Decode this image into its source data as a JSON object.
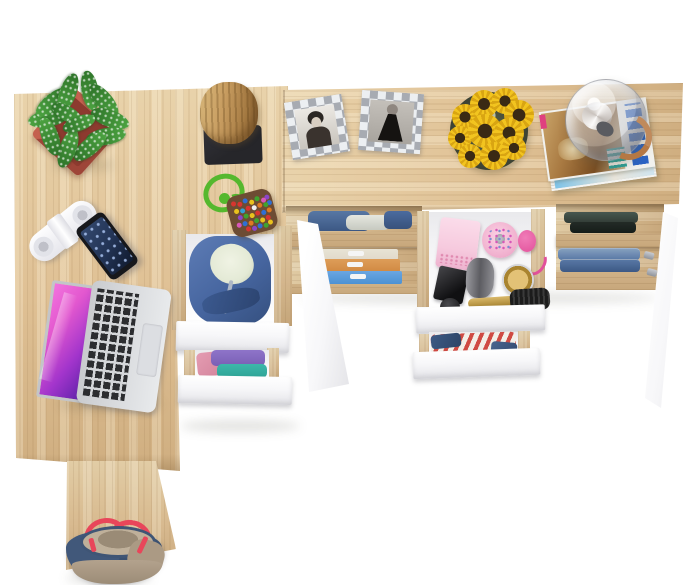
{
  "scene": {
    "description": "Top-down 3D product render of an L-shaped light-oak desk set with white drawers, open storage and styling props on a white background",
    "background_color": "#ffffff",
    "visible_text": "none (magazine title on desk is illegible)"
  },
  "colors": {
    "wood_light": "#e9d3ab",
    "wood_base": "#dfc094",
    "wood_dark": "#cfae80",
    "wood_shelf": "#d8b88c",
    "white_panel": "#f7f7f9",
    "white_panel_shade": "#e4e4e8",
    "white_interior": "#f2f2f4",
    "frame_silver": "#a7abb2",
    "frame_white": "#eceff2",
    "sunflower_yellow": "#f2c41f",
    "sunflower_shade": "#d9a512",
    "sunflower_dark": "#3a2a14",
    "leaf_green": "#4ca341",
    "leaf_green_dark": "#2e7429",
    "pot_red": "#c4614f",
    "pot_red_dark": "#9e4538",
    "cork_tan": "#c79c60",
    "cork_dark": "#8a6234",
    "base_black": "#26262a",
    "rope_green": "#55b82e",
    "pouch_brown": "#6d4c33",
    "phone_black": "#17181c",
    "phone_screen": "#223354",
    "laptop_silver": "#d6d8db",
    "laptop_keys": "#2c2d30",
    "hoodie_blue": "#46659f",
    "hoodie_dark": "#35507f",
    "lining_pale": "#e4ead6",
    "cloth_purple": "#7a5fb5",
    "cloth_teal": "#2fa396",
    "cloth_pink": "#d4849c",
    "jeans_blue": "#5b7cab",
    "jeans_dark": "#3f5c8a",
    "box_beige": "#e9e2d2",
    "box_orange": "#d98f45",
    "box_blue": "#4f97dc",
    "dark_cloth": "#343f38",
    "pink_box": "#f6cade",
    "pink_deep": "#e2519b",
    "gold": "#c8a24e",
    "grey_bottle": "#77777c",
    "stripe_red": "#cf4a43",
    "magazine_blue": "#2b63c4",
    "magazine_teal": "#2aa198",
    "magazine_cover": "#a97a42",
    "lamp_copper": "#c08a5c",
    "bag_navy": "#3a5070",
    "bag_tan": "#b3a28d",
    "strap_red": "#e8465a"
  },
  "items": [
    {
      "label": "Light oak corner desk top (L-shaped)"
    },
    {
      "label": "Desk side support panel"
    },
    {
      "label": "Light oak dressing desk top"
    },
    {
      "label": "Speckled green plant in square terracotta pot"
    },
    {
      "label": "Cork log stool on black base"
    },
    {
      "label": "Beaded pouch keychain with green cord"
    },
    {
      "label": "White power strip"
    },
    {
      "label": "Black smartphone"
    },
    {
      "label": "Silver laptop with magenta wallpaper"
    },
    {
      "label": "Checkered photo frame, black-and-white portrait"
    },
    {
      "label": "Checkered photo frame, woman in black dress"
    },
    {
      "label": "Sunflower bouquet in glass vase"
    },
    {
      "label": "Glass globe lamp"
    },
    {
      "label": "Stack of magazines"
    },
    {
      "label": "Open drawer with blue hoodie"
    },
    {
      "label": "Open drawer with folded purple and teal clothes"
    },
    {
      "label": "Open white cabinet door (left pedestal)"
    },
    {
      "label": "Open shelf with folded jeans and file boxes"
    },
    {
      "label": "Open vanity drawer with cosmetics and brushes"
    },
    {
      "label": "Open drawer with striped clothing and denim"
    },
    {
      "label": "Open shelf with dark clothes and folded jeans"
    },
    {
      "label": "Open white cabinet door (right pedestal)"
    },
    {
      "label": "Navy tote bag with red straps"
    }
  ]
}
